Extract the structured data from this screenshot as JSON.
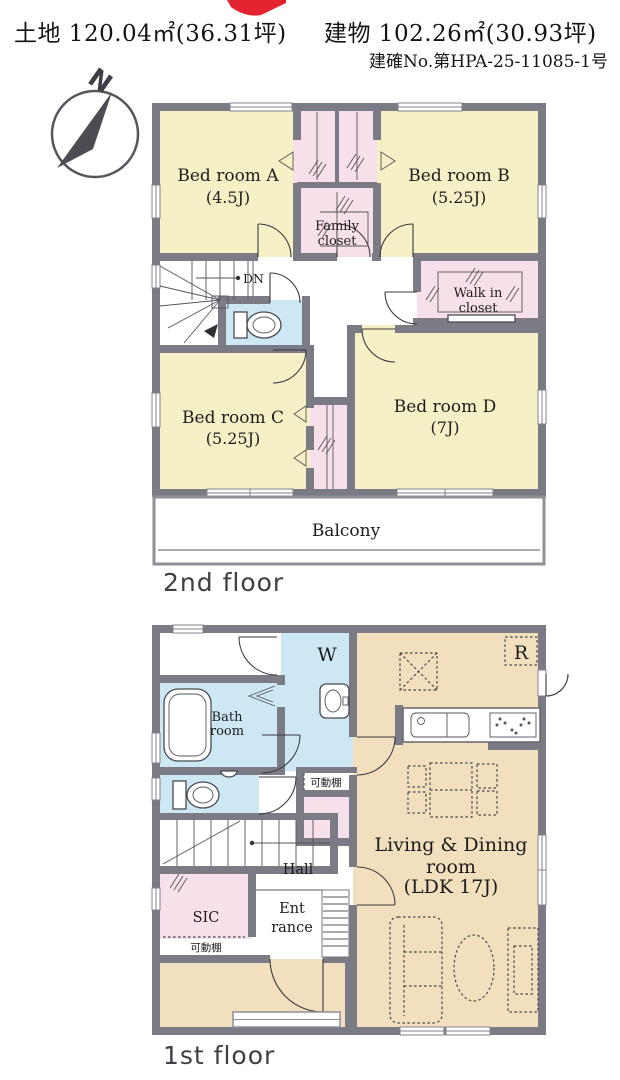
{
  "header": {
    "land": "土地 120.04㎡(36.31坪)",
    "building": "建物 102.26㎡(30.93坪)",
    "approval": "建確No.第HPA-25-11085-1号"
  },
  "compass": {
    "north": "N"
  },
  "floor2": {
    "label": "2nd floor",
    "bedroom_a": {
      "name": "Bed room A",
      "size": "(4.5J)"
    },
    "bedroom_b": {
      "name": "Bed room B",
      "size": "(5.25J)"
    },
    "bedroom_c": {
      "name": "Bed room C",
      "size": "(5.25J)"
    },
    "bedroom_d": {
      "name": "Bed room D",
      "size": "(7J)"
    },
    "family_closet": {
      "line1": "Family",
      "line2": "closet"
    },
    "walk_in_closet": {
      "line1": "Walk in",
      "line2": "closet"
    },
    "stairs_label": "DN",
    "balcony": "Balcony"
  },
  "floor1": {
    "label": "1st floor",
    "bathroom": {
      "line1": "Bath",
      "line2": "room"
    },
    "washer_label": "W",
    "refrigerator_label": "R",
    "hall_label": "Hall",
    "sic_label": "SIC",
    "entrance": {
      "line1": "Ent",
      "line2": "rance"
    },
    "ldk": {
      "line1": "Living & Dining",
      "line2": "room",
      "line3": "(LDK 17J)"
    },
    "shelf_washroom": "可動棚",
    "shelf_sic": "可動棚"
  },
  "colors": {
    "bedroom_yellow": "#f6f0c6",
    "closet_pink": "#f8e0ea",
    "water_blue": "#cde8f4",
    "ldk_tan": "#f1dfbd",
    "wall_gray": "#7b7b85",
    "accent_red": "#e32330"
  }
}
